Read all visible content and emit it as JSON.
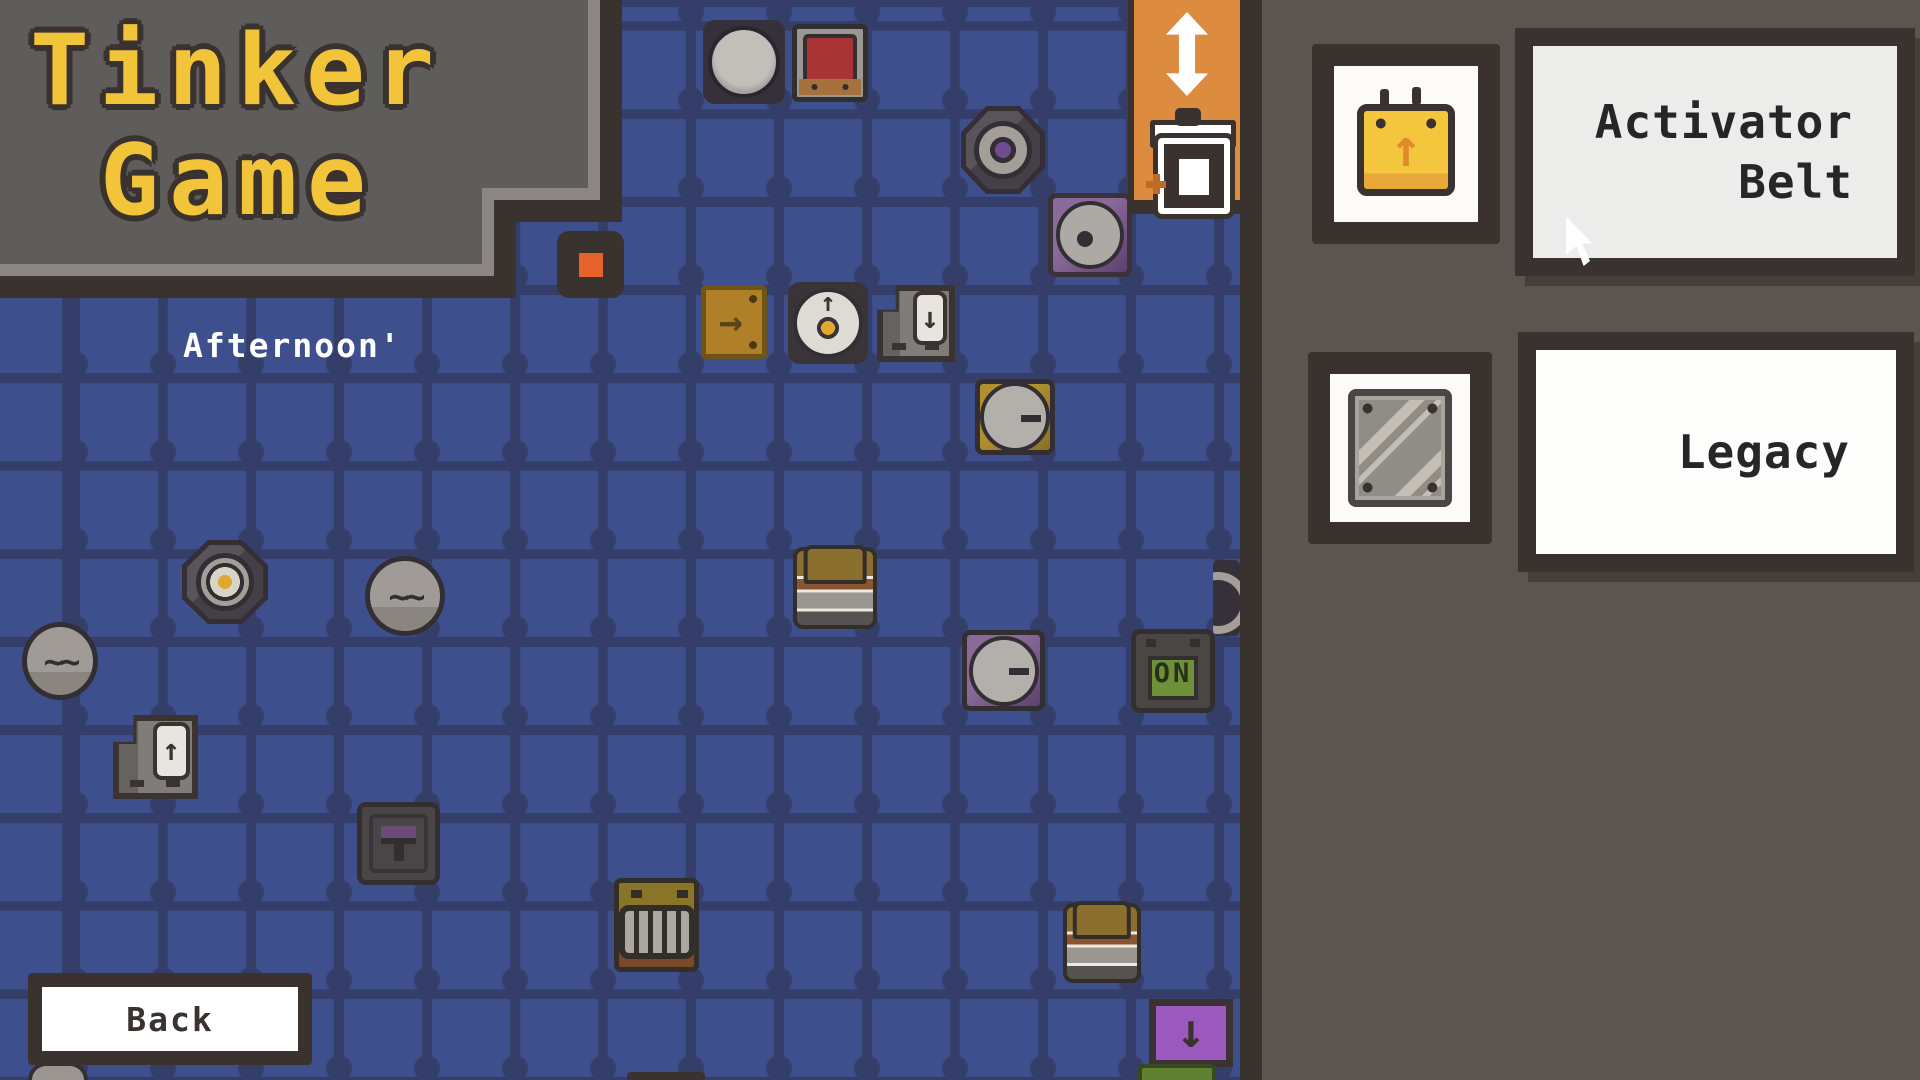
{
  "logo": {
    "line1": "Tinker",
    "line2": "Game"
  },
  "board": {
    "day_label": "Afternoon'",
    "back_label": "Back"
  },
  "tool_panel": {
    "icons": [
      "move-vertical",
      "trash"
    ]
  },
  "sidebar": {
    "items": [
      {
        "id": "activator-belt",
        "label": "Activator Belt",
        "label_line1": "Activator",
        "label_line2": "Belt",
        "icon": "belt-icon"
      },
      {
        "id": "legacy",
        "label": "Legacy",
        "icon": "metal-plate-icon"
      }
    ]
  },
  "colors": {
    "grid_cell": "#3E4F8D",
    "grid_line": "#343E69",
    "sidebar_bg": "#5C5450",
    "dark_border": "#3A322E",
    "tool_panel_orange": "#DD8B3E",
    "logo_yellow": "#F2C43A",
    "logo_accent_orange": "#E07E2E",
    "label_panel_bg": "#ECECEA"
  },
  "pieces": [
    {
      "type": "p-round-button",
      "x": 703,
      "y": 20,
      "w": 82,
      "h": 84
    },
    {
      "type": "p-tv",
      "x": 792,
      "y": 24,
      "w": 76,
      "h": 78
    },
    {
      "type": "p-octagon",
      "x": 961,
      "y": 106,
      "w": 84,
      "h": 88
    },
    {
      "type": "p-eye",
      "x": 1048,
      "y": 193,
      "w": 84,
      "h": 84
    },
    {
      "type": "p-belt-right",
      "x": 701,
      "y": 285,
      "w": 66,
      "h": 74
    },
    {
      "type": "p-dial",
      "x": 788,
      "y": 282,
      "w": 80,
      "h": 82
    },
    {
      "type": "p-floppy",
      "x": 877,
      "y": 285,
      "w": 78,
      "h": 77
    },
    {
      "type": "p-minus-circle p-olive",
      "x": 975,
      "y": 379,
      "w": 80,
      "h": 76
    },
    {
      "type": "p-octagon p-oct-yellow",
      "x": 182,
      "y": 540,
      "w": 86,
      "h": 84
    },
    {
      "type": "p-wheel",
      "x": 365,
      "y": 556,
      "w": 80,
      "h": 80
    },
    {
      "type": "p-wheel",
      "x": 22,
      "y": 622,
      "w": 76,
      "h": 78
    },
    {
      "type": "p-spring",
      "x": 793,
      "y": 547,
      "w": 84,
      "h": 82
    },
    {
      "type": "p-minus-circle p-purple",
      "x": 962,
      "y": 630,
      "w": 83,
      "h": 81
    },
    {
      "type": "p-on",
      "x": 1131,
      "y": 629,
      "w": 84,
      "h": 84,
      "label": "ON"
    },
    {
      "type": "p-edge-disc",
      "x": 1213,
      "y": 560,
      "w": 27,
      "h": 76
    },
    {
      "type": "p-floppy p-floppy-up",
      "x": 113,
      "y": 715,
      "w": 85,
      "h": 84
    },
    {
      "type": "p-t-lever",
      "x": 357,
      "y": 802,
      "w": 83,
      "h": 83
    },
    {
      "type": "p-grill",
      "x": 614,
      "y": 878,
      "w": 85,
      "h": 94
    },
    {
      "type": "p-spring",
      "x": 1063,
      "y": 903,
      "w": 78,
      "h": 80
    },
    {
      "type": "p-purple-arrow",
      "x": 1149,
      "y": 999,
      "w": 84,
      "h": 68
    },
    {
      "type": "p-green-sliver",
      "x": 1138,
      "y": 1064,
      "w": 78,
      "h": 16
    },
    {
      "type": "p-dark-sliver",
      "x": 627,
      "y": 1072,
      "w": 78,
      "h": 8
    },
    {
      "type": "p-part-circle",
      "x": 28,
      "y": 1062,
      "w": 60,
      "h": 18
    },
    {
      "type": "p-orange-dot",
      "x": 557,
      "y": 231,
      "w": 67,
      "h": 67
    }
  ]
}
